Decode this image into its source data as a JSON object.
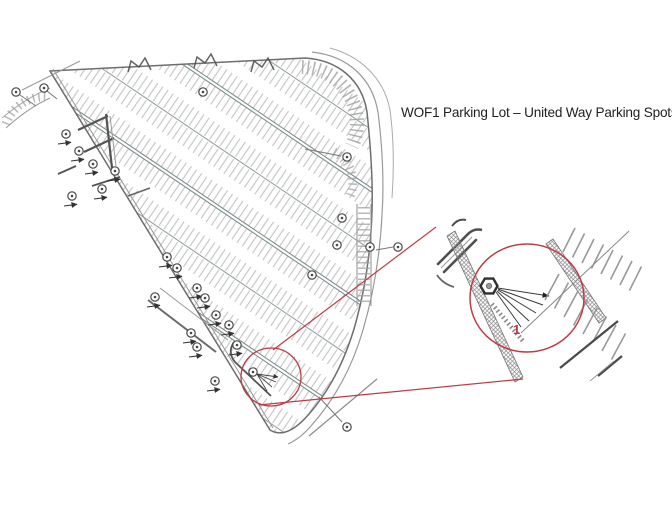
{
  "title": {
    "text": "WOF1 Parking Lot – United Way Parking Spots"
  },
  "inset": {
    "spot_label": "1"
  },
  "map": {
    "light_pole_markers": 27,
    "highlighted_spots": 1
  },
  "colors": {
    "accent_red": "#bf3b45",
    "curb_dark": "#4f4f4f",
    "curb_mid": "#7e7e7e",
    "stall_tick": "#a8a8a8",
    "median_gray": "#8fa0a0",
    "pole_outline": "#4a4a4a",
    "title_text": "#1f1f1f",
    "background": "#ffffff"
  }
}
